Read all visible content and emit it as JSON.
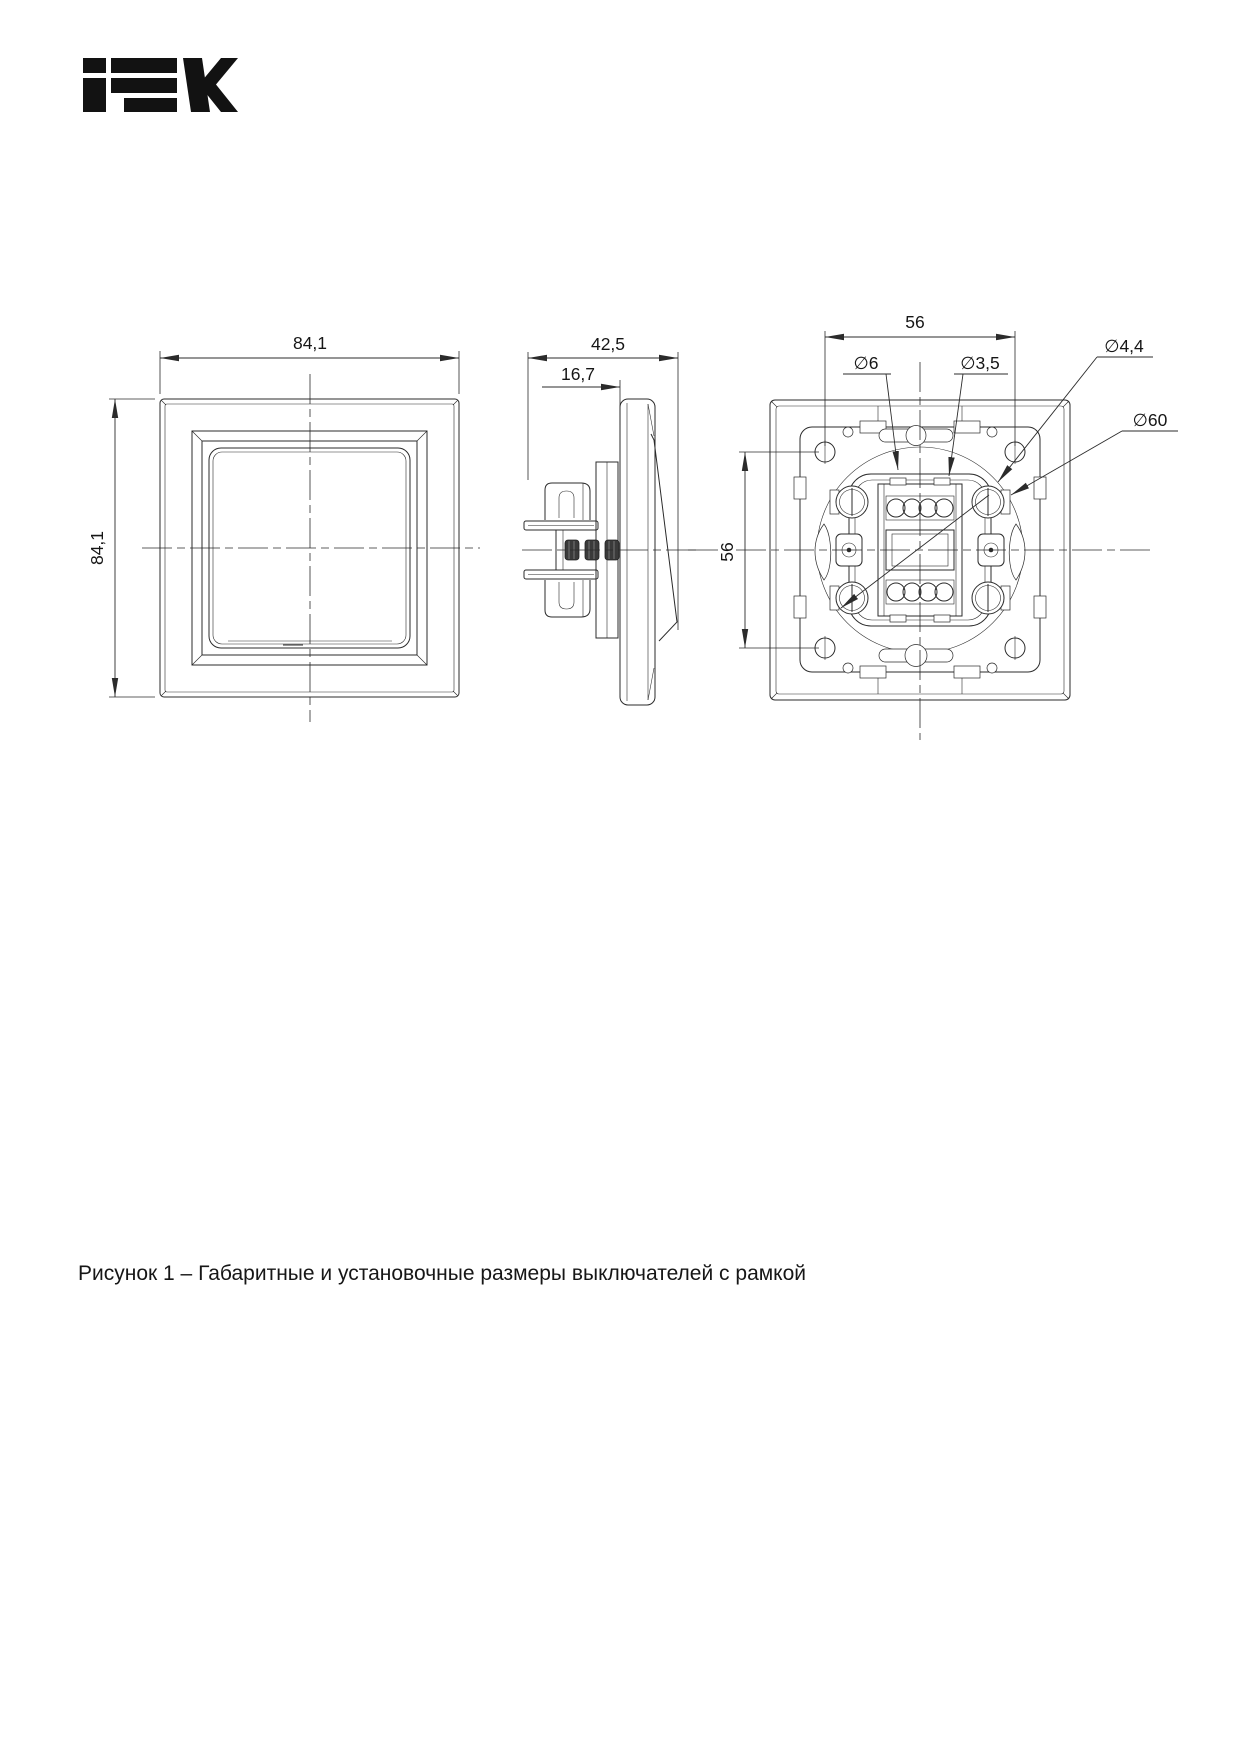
{
  "logo": {
    "text": "IEK"
  },
  "figure": {
    "caption": "Рисунок 1 – Габаритные и установочные размеры выключателей с рамкой"
  },
  "dimensions": {
    "front": {
      "width": "84,1",
      "height": "84,1"
    },
    "side": {
      "total_depth": "42,5",
      "front_depth": "16,7"
    },
    "back": {
      "mount_hole_spacing_horizontal": "56",
      "mount_hole_spacing_vertical": "56",
      "d_plate_hole": "∅6",
      "d_screw_hole": "∅3,5",
      "d_fixing_hole": "∅4,4",
      "d_mounting_circle": "∅60"
    }
  }
}
